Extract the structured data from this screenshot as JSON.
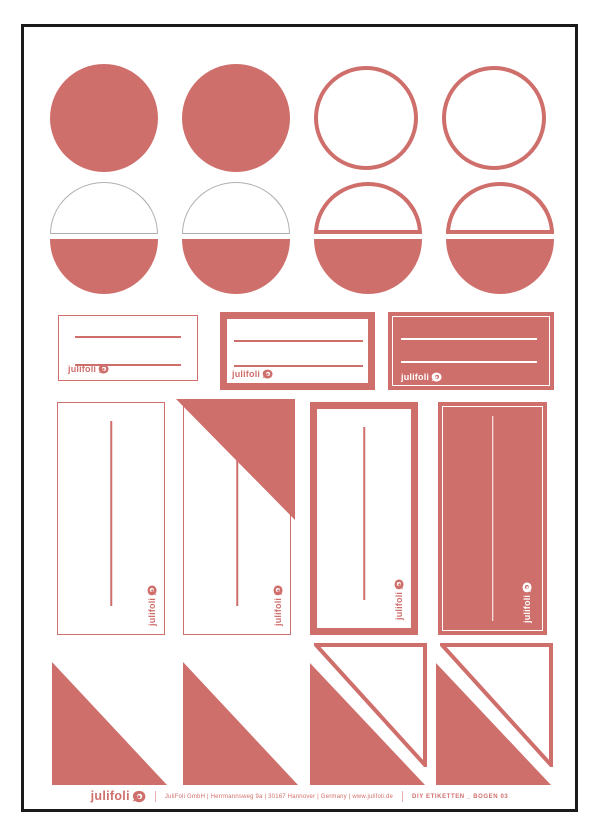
{
  "brand": {
    "logo_text": "julifoli"
  },
  "colors": {
    "accent_coral": "#CF6F6C",
    "outline_gray": "#B0B0B0",
    "frame_black": "#1A1A1A",
    "background": "#FFFFFF"
  },
  "sheet": {
    "row1_circles": [
      "solid",
      "solid",
      "outline",
      "outline"
    ],
    "row2_split_circles": [
      "thin-outline-top",
      "thin-outline-top",
      "thick-outline-top",
      "thick-outline-top"
    ],
    "row3_writing_labels": [
      "thin-border",
      "thick-border",
      "filled-inverse"
    ],
    "row4_tall_labels": [
      "thin-border",
      "thin-border-corner-fold",
      "thick-border",
      "filled-inverse"
    ],
    "row5_triangles": [
      "solid",
      "solid",
      "solid-with-outline",
      "solid-with-outline"
    ]
  },
  "footer": {
    "logo_text": "julifoli",
    "company_line": "JuliFoli GmbH | Herrmannsweg 9a | 30167 Hannover | Germany | www.julifoli.de",
    "sheet_label": "DIY ETIKETTEN _ BOGEN 03"
  }
}
